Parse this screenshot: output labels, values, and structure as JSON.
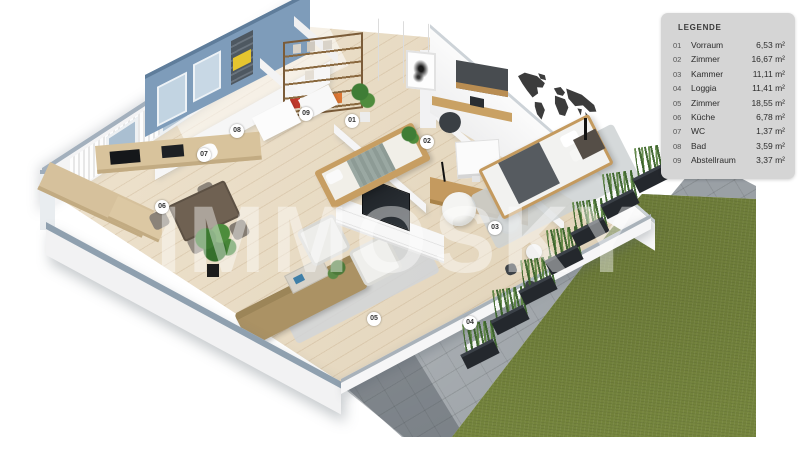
{
  "watermark": "IMMOSKY",
  "legend": {
    "title": "LEGENDE",
    "rows": [
      {
        "no": "01",
        "name": "Vorraum",
        "area": "6,53 m²"
      },
      {
        "no": "02",
        "name": "Zimmer",
        "area": "16,67 m²"
      },
      {
        "no": "03",
        "name": "Kammer",
        "area": "11,11 m²"
      },
      {
        "no": "04",
        "name": "Loggia",
        "area": "11,41 m²"
      },
      {
        "no": "05",
        "name": "Zimmer",
        "area": "18,55 m²"
      },
      {
        "no": "06",
        "name": "Küche",
        "area": "6,78 m²"
      },
      {
        "no": "07",
        "name": "WC",
        "area": "1,37 m²"
      },
      {
        "no": "08",
        "name": "Bad",
        "area": "3,59 m²"
      },
      {
        "no": "09",
        "name": "Abstellraum",
        "area": "3,37 m²"
      }
    ]
  },
  "markers": [
    {
      "label": "01",
      "x": 352,
      "y": 121
    },
    {
      "label": "02",
      "x": 427,
      "y": 142
    },
    {
      "label": "03",
      "x": 495,
      "y": 228
    },
    {
      "label": "04",
      "x": 470,
      "y": 323
    },
    {
      "label": "05",
      "x": 374,
      "y": 319
    },
    {
      "label": "06",
      "x": 162,
      "y": 207
    },
    {
      "label": "07",
      "x": 204,
      "y": 155
    },
    {
      "label": "08",
      "x": 237,
      "y": 131
    },
    {
      "label": "09",
      "x": 306,
      "y": 114
    }
  ],
  "colors": {
    "lawn": "#75853d",
    "terrace": "#9aa0a5",
    "accent_wall": "#7e9cba",
    "wood_floor": "#e9dabd",
    "legend_bg": "#d5d5d5"
  }
}
